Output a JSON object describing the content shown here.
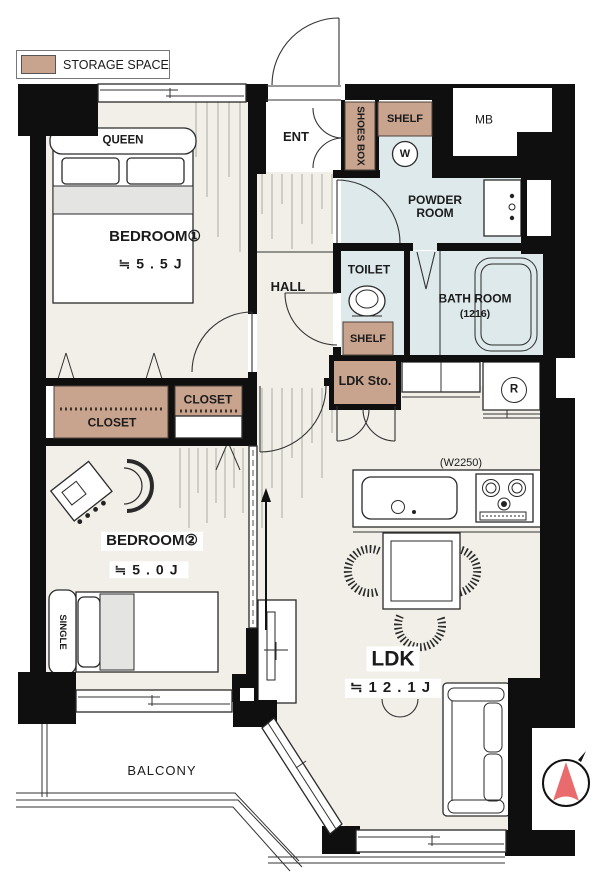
{
  "colors": {
    "wall": "#0f0f0f",
    "beige": "#f1efe8",
    "blue": "#dde9eb",
    "tan": "#c8a38e",
    "gray": "#e4e4e2",
    "red": "#ea6b6e"
  },
  "legend": {
    "storage_label": "STORAGE SPACE"
  },
  "rooms": {
    "bedroom1": {
      "name": "BEDROOM①",
      "size": "≒5.5J"
    },
    "bedroom2": {
      "name": "BEDROOM②",
      "size": "≒5.0J"
    },
    "ldk": {
      "name": "LDK",
      "size": "≒12.1J"
    },
    "hall": {
      "name": "HALL"
    },
    "ent": {
      "name": "ENT"
    },
    "toilet": {
      "name": "TOILET"
    },
    "powder": {
      "name": "POWDER ROOM"
    },
    "bath": {
      "name": "BATH ROOM",
      "size": "(1216)"
    },
    "balcony": {
      "name": "BALCONY"
    }
  },
  "storage": {
    "shoes_box": "SHOES BOX",
    "shelf_entrance": "SHELF",
    "shelf_toilet": "SHELF",
    "ldk_storage": "LDK Sto.",
    "closet1": "CLOSET",
    "closet2": "CLOSET"
  },
  "fixtures": {
    "meter_box": "MB",
    "washing_machine": "W",
    "refrigerator": "R",
    "kitchen_width": "(W2250)"
  },
  "furniture": {
    "queen_bed": "QUEEN",
    "single_bed": "SINGLE"
  }
}
